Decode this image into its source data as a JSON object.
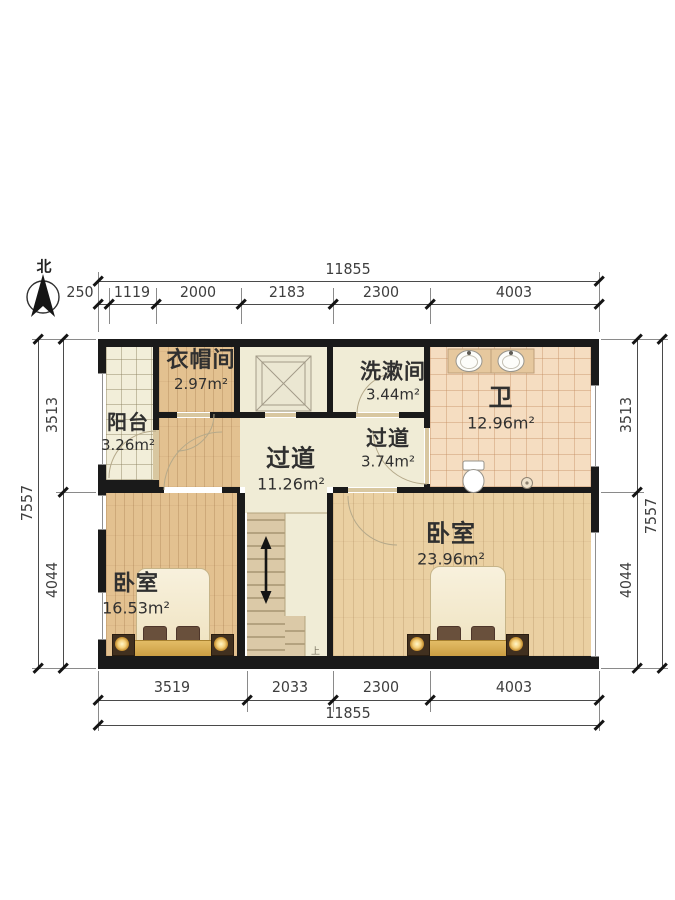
{
  "compass": {
    "north_label": "北"
  },
  "rooms": {
    "cloakroom": {
      "name": "衣帽间",
      "area": "2.97m²"
    },
    "balcony": {
      "name": "阳台",
      "area": "3.26m²"
    },
    "washroom": {
      "name": "洗漱间",
      "area": "3.44m²"
    },
    "bathroom": {
      "name": "卫",
      "area": "12.96m²"
    },
    "hallway_main": {
      "name": "过道",
      "area": "11.26m²"
    },
    "hallway_small": {
      "name": "过道",
      "area": "3.74m²"
    },
    "bedroom_left": {
      "name": "卧室",
      "area": "16.53m²"
    },
    "bedroom_right": {
      "name": "卧室",
      "area": "23.96m²"
    },
    "stairs": {
      "up_label": "上"
    }
  },
  "dimensions": {
    "top": {
      "total": "11855",
      "segments": [
        "250",
        "1119",
        "2000",
        "2183",
        "2300",
        "4003"
      ]
    },
    "bottom": {
      "total": "11855",
      "segments": [
        "3519",
        "2033",
        "2300",
        "4003"
      ]
    },
    "left": {
      "total": "7557",
      "segments": [
        "3513",
        "4044"
      ]
    },
    "right": {
      "total": "7557",
      "segments": [
        "3513",
        "4044"
      ]
    }
  },
  "colors": {
    "wall": "#1a1a1a",
    "wood_floor": "#e3c190",
    "bath_tile": "#f5ddc1",
    "corridor": "#f0ecd6",
    "blanket_gold": "#d9ae55"
  }
}
